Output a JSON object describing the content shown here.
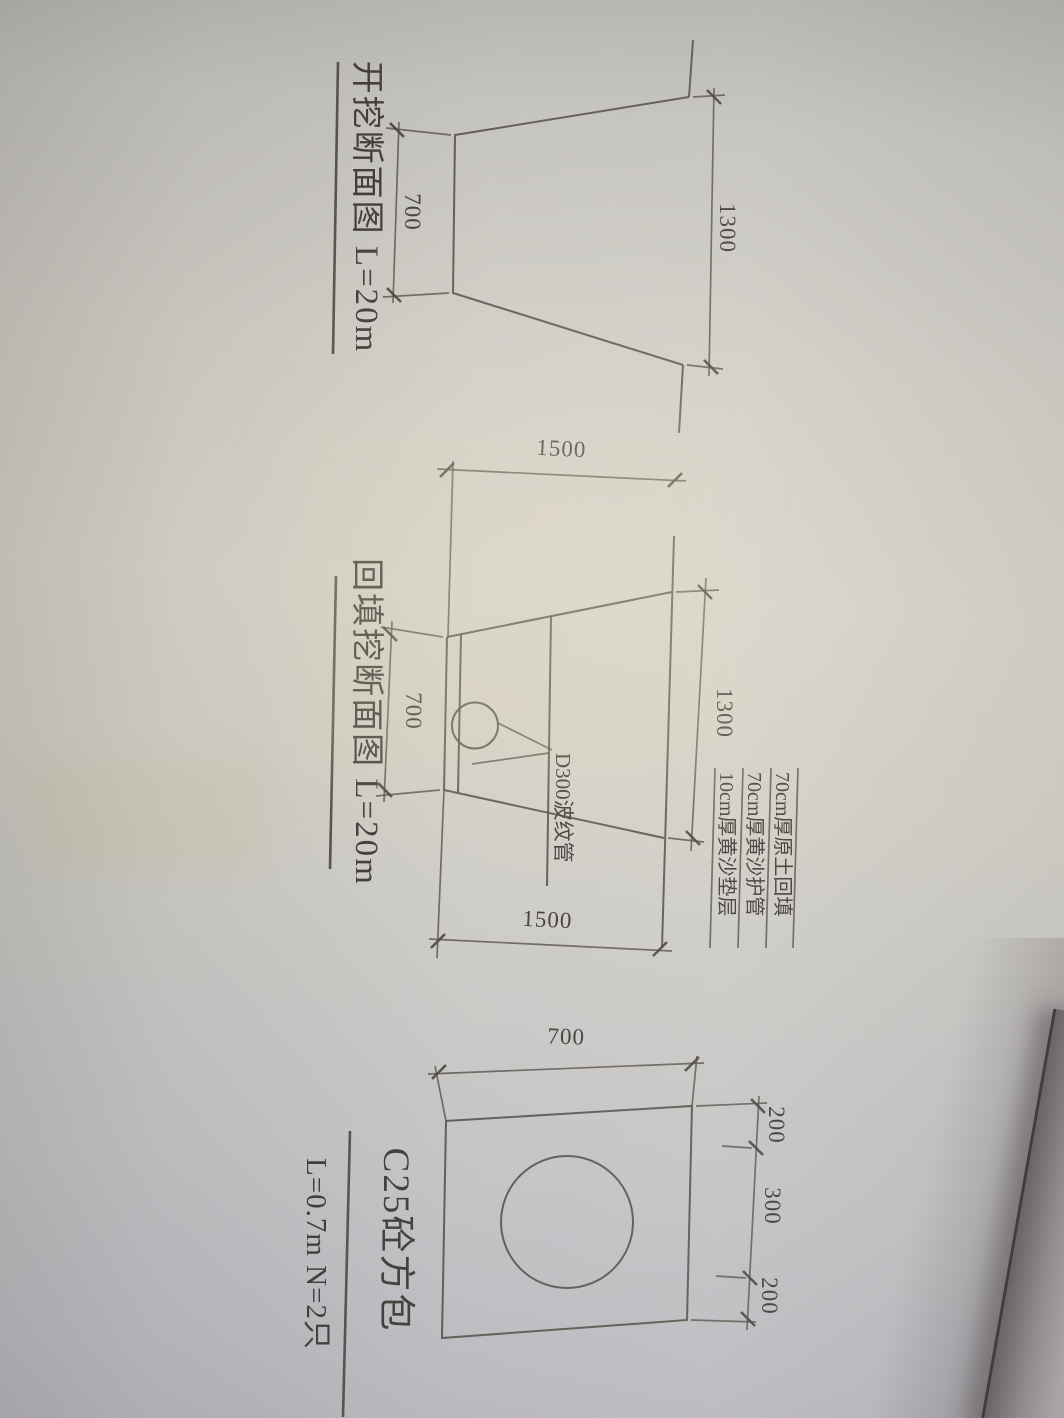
{
  "photo": {
    "paper_color": "#d0cdc5",
    "ink_color": "#46403a",
    "desk_color": "#8f898c"
  },
  "figures": {
    "excavation": {
      "caption": "开挖断面图 L=20m",
      "dim_top_width": "1300",
      "dim_bottom_width": "700"
    },
    "backfill": {
      "caption": "回填挖断面图 L=20m",
      "dim_top_width": "1300",
      "dim_bottom_width": "700",
      "dim_depth_left": "1500",
      "dim_depth_right": "1500",
      "pipe_label": "D300波纹管",
      "layer_labels": [
        "70cm厚原土回填",
        "70cm厚黄沙护管",
        "10cm厚黄沙垫层"
      ]
    },
    "concrete_casing": {
      "caption_title": "C25砼方包",
      "caption_note": "L=0.7m N=2只",
      "dim_height": "700",
      "dim_top_segments": [
        "200",
        "300",
        "200"
      ]
    }
  }
}
